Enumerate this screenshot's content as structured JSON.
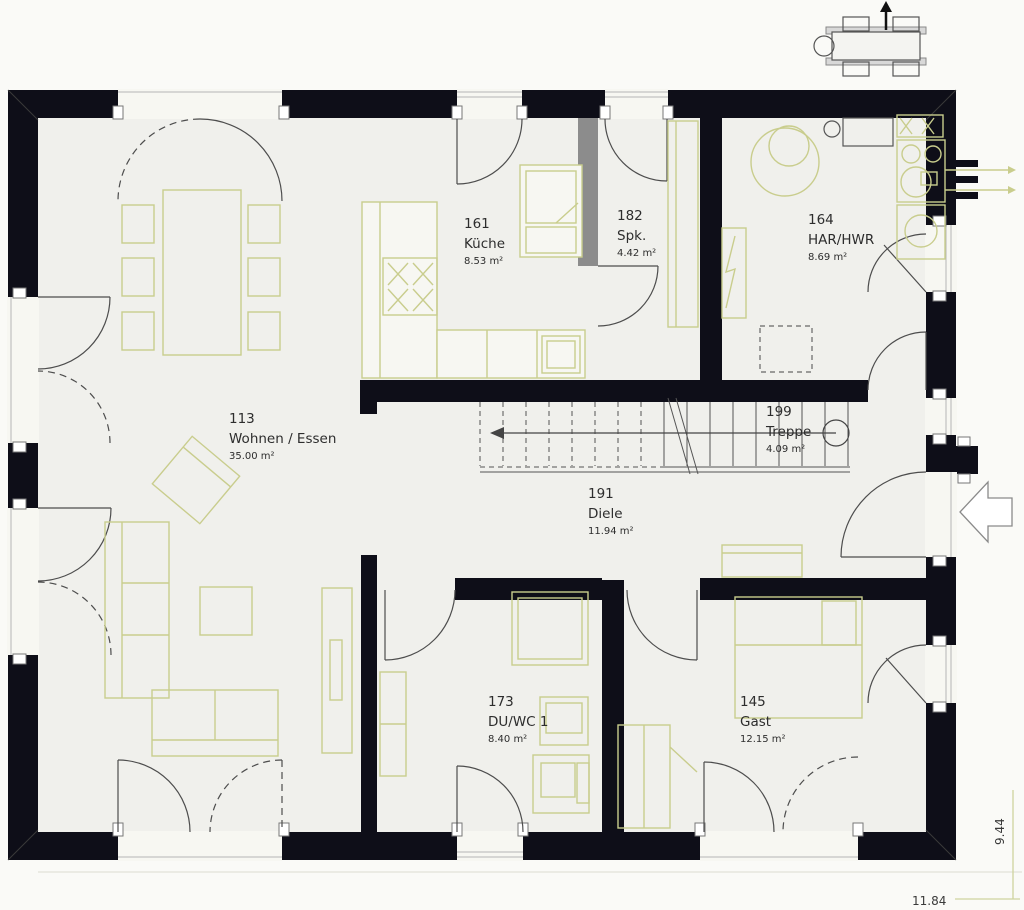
{
  "floorplan": {
    "rooms": [
      {
        "number": "113",
        "name": "Wohnen / Essen",
        "area": "35.00 m²"
      },
      {
        "number": "161",
        "name": "Küche",
        "area": "8.53 m²"
      },
      {
        "number": "182",
        "name": "Spk.",
        "area": "4.42 m²"
      },
      {
        "number": "164",
        "name": "HAR/HWR",
        "area": "8.69 m²"
      },
      {
        "number": "199",
        "name": "Treppe",
        "area": "4.09 m²"
      },
      {
        "number": "191",
        "name": "Diele",
        "area": "11.94 m²"
      },
      {
        "number": "173",
        "name": "DU/WC 1",
        "area": "8.40 m²"
      },
      {
        "number": "145",
        "name": "Gast",
        "area": "12.15 m²"
      }
    ],
    "dimensions": {
      "width_label": "11.84",
      "height_label": "9.44"
    },
    "colors": {
      "wall": "#0e0e18",
      "furniture_line": "#c9cd8d",
      "door_line": "#4d4d4d",
      "gray_wall": "#8c8c8c",
      "dimension_line": "#cfd49e"
    }
  }
}
